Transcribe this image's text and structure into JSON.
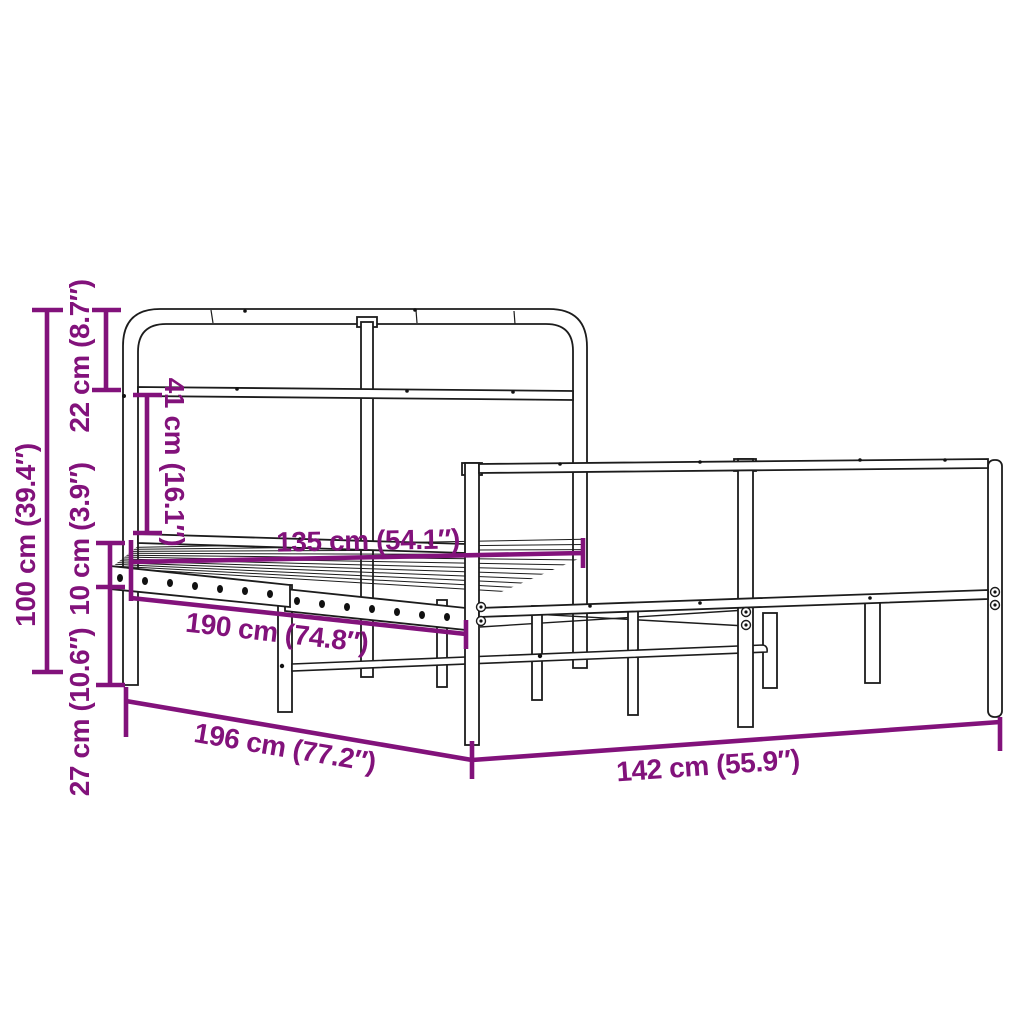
{
  "page": {
    "background_color": "#ffffff",
    "accent_color": "#82127B",
    "line_color": "#1c1c1c"
  },
  "diagram": {
    "type": "product-dimension-diagram",
    "subject": "metal bed frame with headboard and footboard, slatted base",
    "dimensions": [
      {
        "id": "total-height",
        "label": "100 cm (39.4″)",
        "value_cm": 100,
        "value_in": 39.4,
        "orientation": "vertical"
      },
      {
        "id": "headboard-top-section",
        "label": "22 cm (8.7″)",
        "value_cm": 22,
        "value_in": 8.7,
        "orientation": "vertical"
      },
      {
        "id": "headboard-mid-gap",
        "label": "41 cm (16.1″)",
        "value_cm": 41,
        "value_in": 16.1,
        "orientation": "vertical"
      },
      {
        "id": "rail-height",
        "label": "10 cm (3.9″)",
        "value_cm": 10,
        "value_in": 3.9,
        "orientation": "vertical"
      },
      {
        "id": "floor-clearance",
        "label": "27 cm (10.6″)",
        "value_cm": 27,
        "value_in": 10.6,
        "orientation": "vertical"
      },
      {
        "id": "inner-length",
        "label": "135 cm (54.1″)",
        "value_cm": 135,
        "value_in": 54.1,
        "orientation": "horizontal"
      },
      {
        "id": "slat-area-length",
        "label": "190 cm (74.8″)",
        "value_cm": 190,
        "value_in": 74.8,
        "orientation": "diagonal"
      },
      {
        "id": "total-length",
        "label": "196 cm (77.2″)",
        "value_cm": 196,
        "value_in": 77.2,
        "orientation": "diagonal"
      },
      {
        "id": "total-width",
        "label": "142 cm (55.9″)",
        "value_cm": 142,
        "value_in": 55.9,
        "orientation": "horizontal"
      }
    ]
  }
}
